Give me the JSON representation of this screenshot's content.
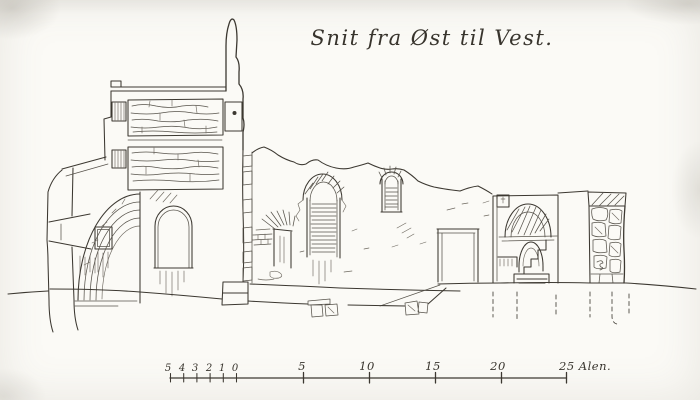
{
  "page": {
    "paper_color": "#fbfaf6",
    "ink_color": "#3c3831"
  },
  "title": {
    "text": "Snit fra Øst til Vest."
  },
  "drawing": {
    "subject": "Sectional elevation of a ruined church, drawn from east to west",
    "elements": [
      "apse with half-dome vault and splayed window",
      "tower in section with masonry floor bands and arched window",
      "ruined nave wall with large and small arched windows and a doorway",
      "wall fragment with rectangular door and arched niche with steps",
      "rubble masonry pier",
      "ground line with loose foundation stones",
      "dashed excavation lines below grade"
    ]
  },
  "scale_bar": {
    "minor_labels": [
      "5",
      "4",
      "3",
      "2",
      "1",
      "0"
    ],
    "major_labels": [
      "5",
      "10",
      "15",
      "20"
    ],
    "end_label": "25 Alen.",
    "unit": "Alen"
  }
}
